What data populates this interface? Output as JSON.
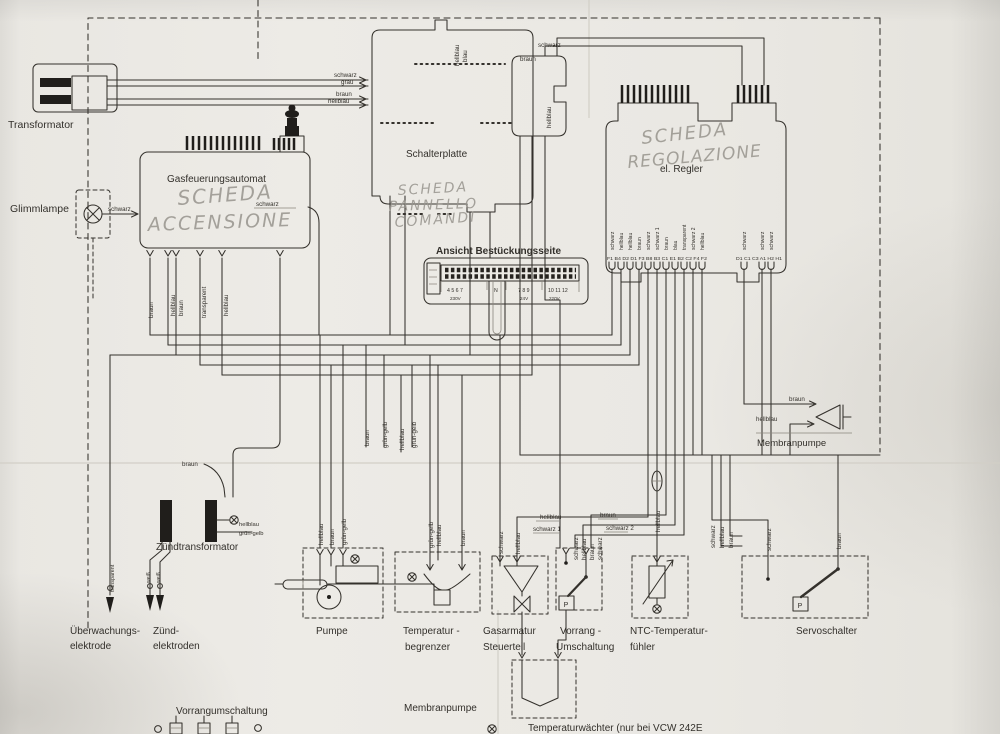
{
  "meta": {
    "document_type": "Schaltplan (gescannter Stromlaufplan)",
    "visible_device_reference": "VCW 242E",
    "languages": [
      "Deutsch",
      "Italienisch (handschriftlich)"
    ]
  },
  "colors": {
    "paper": "#e9e7e2",
    "ink": "#34312c",
    "pencil_handwriting": "#97948d"
  },
  "labels": [
    {
      "name": "transformator-label",
      "text": "Transformator",
      "x": 8,
      "y": 128,
      "size": 10.5
    },
    {
      "name": "glimmlampe-label",
      "text": "Glimmlampe",
      "x": 10,
      "y": 212,
      "size": 10.5
    },
    {
      "name": "gasfeuerungsautomat-label",
      "text": "Gasfeuerungsautomat",
      "x": 167,
      "y": 182,
      "size": 10
    },
    {
      "name": "schalterplatte-label",
      "text": "Schalterplatte",
      "x": 406,
      "y": 157,
      "size": 10
    },
    {
      "name": "el-regler-label",
      "text": "el. Regler",
      "x": 660,
      "y": 172,
      "size": 10
    },
    {
      "name": "bestueckungsseite-label",
      "text": "Ansicht Bestückungsseite",
      "x": 436,
      "y": 254,
      "size": 10,
      "cls": "b"
    },
    {
      "name": "zuendtransformator-label",
      "text": "Zündtransformator",
      "x": 156,
      "y": 550,
      "size": 10
    },
    {
      "name": "membranpumpe-right-label",
      "text": "Membranpumpe",
      "x": 757,
      "y": 446,
      "size": 9.5
    },
    {
      "name": "ueberwachungselektrode-label-line1",
      "text": "Überwachungs-",
      "x": 70,
      "y": 634,
      "size": 10
    },
    {
      "name": "ueberwachungselektrode-label-line2",
      "text": "elektrode",
      "x": 70,
      "y": 649,
      "size": 10
    },
    {
      "name": "zuendelektroden-label-line1",
      "text": "Zünd-",
      "x": 153,
      "y": 634,
      "size": 10
    },
    {
      "name": "zuendelektroden-label-line2",
      "text": "elektroden",
      "x": 153,
      "y": 649,
      "size": 10
    },
    {
      "name": "pumpe-label",
      "text": "Pumpe",
      "x": 316,
      "y": 634,
      "size": 10
    },
    {
      "name": "temperaturbegrenzer-label-line1",
      "text": "Temperatur -",
      "x": 403,
      "y": 634,
      "size": 10
    },
    {
      "name": "temperaturbegrenzer-label-line2",
      "text": "begrenzer",
      "x": 405,
      "y": 650,
      "size": 10
    },
    {
      "name": "gasarmatur-label-line1",
      "text": "Gasarmatur",
      "x": 483,
      "y": 634,
      "size": 10
    },
    {
      "name": "gasarmatur-label-line2",
      "text": "Steuerteil",
      "x": 483,
      "y": 650,
      "size": 10
    },
    {
      "name": "vorrang-label-line1",
      "text": "Vorrang -",
      "x": 560,
      "y": 634,
      "size": 10
    },
    {
      "name": "vorrang-label-line2",
      "text": "Umschaltung",
      "x": 556,
      "y": 650,
      "size": 10
    },
    {
      "name": "ntc-label-line1",
      "text": "NTC-Temperatur-",
      "x": 630,
      "y": 634,
      "size": 10
    },
    {
      "name": "ntc-label-line2",
      "text": "fühler",
      "x": 630,
      "y": 650,
      "size": 10
    },
    {
      "name": "servoschalter-label",
      "text": "Servoschalter",
      "x": 796,
      "y": 634,
      "size": 10
    },
    {
      "name": "vorrangumschaltung-bottom-label",
      "text": "Vorrangumschaltung",
      "x": 176,
      "y": 714,
      "size": 10
    },
    {
      "name": "membranpumpe-bottom-label",
      "text": "Membranpumpe",
      "x": 404,
      "y": 711,
      "size": 10
    },
    {
      "name": "temperaturwaechter-label",
      "text": "Temperaturwächter  (nur bei VCW 242E",
      "x": 528,
      "y": 731,
      "size": 10
    },
    {
      "name": "wire-label-schwarz-trafo",
      "text": "schwarz",
      "x": 334,
      "y": 77
    },
    {
      "name": "wire-label-grau-trafo",
      "text": "grau",
      "x": 341,
      "y": 84
    },
    {
      "name": "wire-label-braun-trafo",
      "text": "braun",
      "x": 336,
      "y": 96
    },
    {
      "name": "wire-label-hellblau-trafo",
      "text": "hellblau",
      "x": 328,
      "y": 103
    },
    {
      "name": "wire-label-schwarz-glimmlampe",
      "text": "schwarz",
      "x": 108,
      "y": 211
    },
    {
      "name": "wire-label-schwarz-gasautomat",
      "text": "schwarz",
      "x": 256,
      "y": 206
    },
    {
      "name": "wire-label-braun-schalterplatte",
      "text": "braun",
      "x": 520,
      "y": 61
    },
    {
      "name": "wire-label-schwarz-schalterplatte",
      "text": "schwarz",
      "x": 538,
      "y": 47
    },
    {
      "name": "wire-label-hellblau-connector",
      "text": "hellblau",
      "x": 551,
      "y": 128,
      "rot": -90
    },
    {
      "name": "wire-label-hellblau-schalterplatte-top",
      "text": "hellblau",
      "x": 459,
      "y": 66,
      "rot": -90
    },
    {
      "name": "wire-label-blau-schalterplatte-top",
      "text": "blau",
      "x": 467,
      "y": 62,
      "rot": -90
    },
    {
      "name": "wire-label-braun-membranpumpe",
      "text": "braun",
      "x": 789,
      "y": 401
    },
    {
      "name": "wire-label-hellblau-membranpumpe",
      "text": "hellblau",
      "x": 756,
      "y": 421
    },
    {
      "name": "wire-label-braun-zuendtrafo",
      "text": "braun",
      "x": 182,
      "y": 466
    },
    {
      "name": "wire-label-hellblau-zuendtrafo",
      "text": "hellblau",
      "x": 239,
      "y": 526,
      "size": 5.8
    },
    {
      "name": "wire-label-gruengelb-zuendtrafo",
      "text": "grün-gelb",
      "x": 239,
      "y": 535,
      "size": 5.8
    },
    {
      "name": "wire-label-braun-gasautomat-pin1",
      "text": "braun",
      "x": 153,
      "y": 318,
      "rot": -90
    },
    {
      "name": "wire-label-hellblau-gasautomat-pin2",
      "text": "hellblau",
      "x": 175,
      "y": 316,
      "rot": -90
    },
    {
      "name": "wire-label-braun-gasautomat-pin3",
      "text": "braun",
      "x": 183,
      "y": 316,
      "rot": -90
    },
    {
      "name": "wire-label-transparent-gasautomat-pin4",
      "text": "transparent",
      "x": 206,
      "y": 318,
      "rot": -90
    },
    {
      "name": "wire-label-hellblau-gasautomat-pin5",
      "text": "hellblau",
      "x": 228,
      "y": 316,
      "rot": -90
    },
    {
      "name": "wire-label-transparent-elektrode",
      "text": "transparent",
      "x": 114,
      "y": 592,
      "rot": -90,
      "size": 5.4
    },
    {
      "name": "wire-label-weiss-elektrode-1",
      "text": "weiß",
      "x": 150,
      "y": 583,
      "rot": -90,
      "size": 5.2
    },
    {
      "name": "wire-label-weiss-elektrode-2",
      "text": "weiß",
      "x": 160,
      "y": 583,
      "rot": -90,
      "size": 5.2
    },
    {
      "name": "wire-label-braun-erdung-1",
      "text": "braun",
      "x": 369,
      "y": 446,
      "rot": -90
    },
    {
      "name": "wire-label-gruengelb-erdung-1",
      "text": "grün-gelb",
      "x": 387,
      "y": 448,
      "rot": -90
    },
    {
      "name": "wire-label-hellblau-mitte",
      "text": "hellblau",
      "x": 404,
      "y": 450,
      "rot": -90
    },
    {
      "name": "wire-label-gruengelb-erdung-2",
      "text": "grün-gelb",
      "x": 416,
      "y": 448,
      "rot": -90
    },
    {
      "name": "wire-label-hellblau-pumpe",
      "text": "hellblau",
      "x": 323,
      "y": 545,
      "rot": -90
    },
    {
      "name": "wire-label-braun-pumpe",
      "text": "braun",
      "x": 334,
      "y": 545,
      "rot": -90
    },
    {
      "name": "wire-label-gruengelb-pumpe",
      "text": "grün-gelb",
      "x": 346,
      "y": 545,
      "rot": -90
    },
    {
      "name": "wire-label-gruengelb-begrenzer",
      "text": "grün-gelb",
      "x": 433,
      "y": 548,
      "rot": -90
    },
    {
      "name": "wire-label-hellblau-begrenzer",
      "text": "hellblau",
      "x": 441,
      "y": 546,
      "rot": -90
    },
    {
      "name": "wire-label-braun-begrenzer",
      "text": "braun",
      "x": 465,
      "y": 546,
      "rot": -90
    },
    {
      "name": "wire-label-hellblau-gasarmatur",
      "text": "hellblau",
      "x": 540,
      "y": 519
    },
    {
      "name": "wire-label-schwarz1-gasarmatur",
      "text": "schwarz 1",
      "x": 533,
      "y": 531
    },
    {
      "name": "wire-label-braun-vorrang",
      "text": "braun",
      "x": 600,
      "y": 517
    },
    {
      "name": "wire-label-schwarz2-vorrang",
      "text": "schwarz 2",
      "x": 606,
      "y": 530
    },
    {
      "name": "wire-label-schwarz-gasarmatur-v",
      "text": "schwarz",
      "x": 503,
      "y": 554,
      "rot": -90
    },
    {
      "name": "wire-label-hellblau-gasarmatur-v",
      "text": "hellblau",
      "x": 520,
      "y": 554,
      "rot": -90
    },
    {
      "name": "wire-label-schwarz-vorrang-v1",
      "text": "schwarz",
      "x": 578,
      "y": 560,
      "rot": -90
    },
    {
      "name": "wire-label-hellblau-vorrang-v",
      "text": "hellblau",
      "x": 586,
      "y": 560,
      "rot": -90
    },
    {
      "name": "wire-label-braun-vorrang-v",
      "text": "braun",
      "x": 594,
      "y": 560,
      "rot": -90
    },
    {
      "name": "wire-label-schwarz-vorrang-v2",
      "text": "schwarz",
      "x": 602,
      "y": 560,
      "rot": -90
    },
    {
      "name": "wire-label-hellblau-ntc",
      "text": "hellblau",
      "x": 660,
      "y": 532,
      "rot": -90
    },
    {
      "name": "wire-label-schwarz-servo-zuleitung",
      "text": "schwarz",
      "x": 715,
      "y": 548,
      "rot": -90
    },
    {
      "name": "wire-label-hellblau-servo-zuleitung",
      "text": "hellblau",
      "x": 724,
      "y": 548,
      "rot": -90
    },
    {
      "name": "wire-label-braun-servo-zuleitung",
      "text": "braun",
      "x": 733,
      "y": 548,
      "rot": -90
    },
    {
      "name": "wire-label-schwarz-servo",
      "text": "schwarz",
      "x": 771,
      "y": 551,
      "rot": -90
    },
    {
      "name": "wire-label-braun-servo",
      "text": "braun",
      "x": 841,
      "y": 549,
      "rot": -90
    },
    {
      "name": "regler-pin-label-1",
      "text": "schwarz",
      "x": 614,
      "y": 250,
      "rot": -90,
      "size": 5
    },
    {
      "name": "regler-pin-label-2",
      "text": "hellblau",
      "x": 623,
      "y": 250,
      "rot": -90,
      "size": 5
    },
    {
      "name": "regler-pin-label-3",
      "text": "hellblau",
      "x": 632,
      "y": 250,
      "rot": -90,
      "size": 5
    },
    {
      "name": "regler-pin-label-4",
      "text": "braun",
      "x": 641,
      "y": 250,
      "rot": -90,
      "size": 5
    },
    {
      "name": "regler-pin-label-5",
      "text": "schwarz",
      "x": 650,
      "y": 250,
      "rot": -90,
      "size": 5
    },
    {
      "name": "regler-pin-label-6",
      "text": "schwarz 1",
      "x": 659,
      "y": 250,
      "rot": -90,
      "size": 5
    },
    {
      "name": "regler-pin-label-7",
      "text": "braun",
      "x": 668,
      "y": 250,
      "rot": -90,
      "size": 5
    },
    {
      "name": "regler-pin-label-8",
      "text": "blau",
      "x": 677,
      "y": 250,
      "rot": -90,
      "size": 5
    },
    {
      "name": "regler-pin-label-9",
      "text": "transparent",
      "x": 686,
      "y": 250,
      "rot": -90,
      "size": 5
    },
    {
      "name": "regler-pin-label-10",
      "text": "schwarz 2",
      "x": 695,
      "y": 250,
      "rot": -90,
      "size": 5
    },
    {
      "name": "regler-pin-label-11",
      "text": "hellblau",
      "x": 704,
      "y": 250,
      "rot": -90,
      "size": 5
    },
    {
      "name": "regler-pin-label-12",
      "text": "schwarz",
      "x": 746,
      "y": 250,
      "rot": -90,
      "size": 5
    },
    {
      "name": "regler-pin-label-13",
      "text": "schwarz",
      "x": 764,
      "y": 250,
      "rot": -90,
      "size": 5
    },
    {
      "name": "regler-pin-label-14",
      "text": "schwarz",
      "x": 773,
      "y": 250,
      "rot": -90,
      "size": 5
    },
    {
      "name": "regler-terminal-row-left",
      "text": "F1 B4 D2 D1 F3 B8 B3 C1 E1 B2 C2 F4 F2",
      "x": 607,
      "y": 260,
      "size": 4.6,
      "tl": 100
    },
    {
      "name": "regler-terminal-row-right",
      "text": "D1 C1 C3 A1 H2 H1",
      "x": 736,
      "y": 260,
      "size": 4.6,
      "tl": 46
    },
    {
      "name": "klemmleiste-numbers-1",
      "text": "4 5 6 7",
      "x": 447,
      "y": 292,
      "size": 5.2
    },
    {
      "name": "klemmleiste-numbers-n",
      "text": "N",
      "x": 494,
      "y": 292,
      "size": 5.2
    },
    {
      "name": "klemmleiste-numbers-2",
      "text": "7 8 9",
      "x": 518,
      "y": 292,
      "size": 5.2
    },
    {
      "name": "klemmleiste-numbers-3",
      "text": "10 11 12",
      "x": 548,
      "y": 292,
      "size": 5.2
    },
    {
      "name": "klemmleiste-voltage-230",
      "text": "230V",
      "x": 450,
      "y": 300,
      "size": 4.6
    },
    {
      "name": "klemmleiste-voltage-24",
      "text": "24V",
      "x": 520,
      "y": 300,
      "size": 4.6
    },
    {
      "name": "klemmleiste-voltage-220",
      "text": "220V",
      "x": 549,
      "y": 300,
      "size": 4.6
    },
    {
      "name": "vorrang-p-label",
      "text": "P",
      "x": 566,
      "y": 607,
      "size": 7,
      "anchor": "middle"
    },
    {
      "name": "servo-p-label",
      "text": "P",
      "x": 800,
      "y": 608,
      "size": 7,
      "anchor": "middle"
    }
  ],
  "handwritten": [
    {
      "name": "handwriting-scheda-accensione-1",
      "text": "SCHEDA",
      "x": 178,
      "y": 205,
      "size": 20,
      "rot": -4,
      "ls": 2
    },
    {
      "name": "handwriting-scheda-accensione-2",
      "text": "ACCENSIONE",
      "x": 148,
      "y": 231,
      "size": 19,
      "rot": -2,
      "ls": 2
    },
    {
      "name": "handwriting-scheda-pannello-1",
      "text": "SCHEDA",
      "x": 398,
      "y": 195,
      "size": 14,
      "rot": -3,
      "ls": 2
    },
    {
      "name": "handwriting-scheda-pannello-2",
      "text": "PANNELLO",
      "x": 389,
      "y": 211,
      "size": 14,
      "rot": -2,
      "ls": 2
    },
    {
      "name": "handwriting-scheda-pannello-3",
      "text": "COMANDI",
      "x": 395,
      "y": 227,
      "size": 14,
      "rot": -4,
      "ls": 2
    },
    {
      "name": "handwriting-scheda-regolazione-1",
      "text": "SCHEDA",
      "x": 642,
      "y": 144,
      "size": 18,
      "rot": -6,
      "ls": 2
    },
    {
      "name": "handwriting-scheda-regolazione-2",
      "text": "REGOLAZIONE",
      "x": 628,
      "y": 168,
      "size": 17,
      "rot": -5,
      "ls": 1
    }
  ]
}
